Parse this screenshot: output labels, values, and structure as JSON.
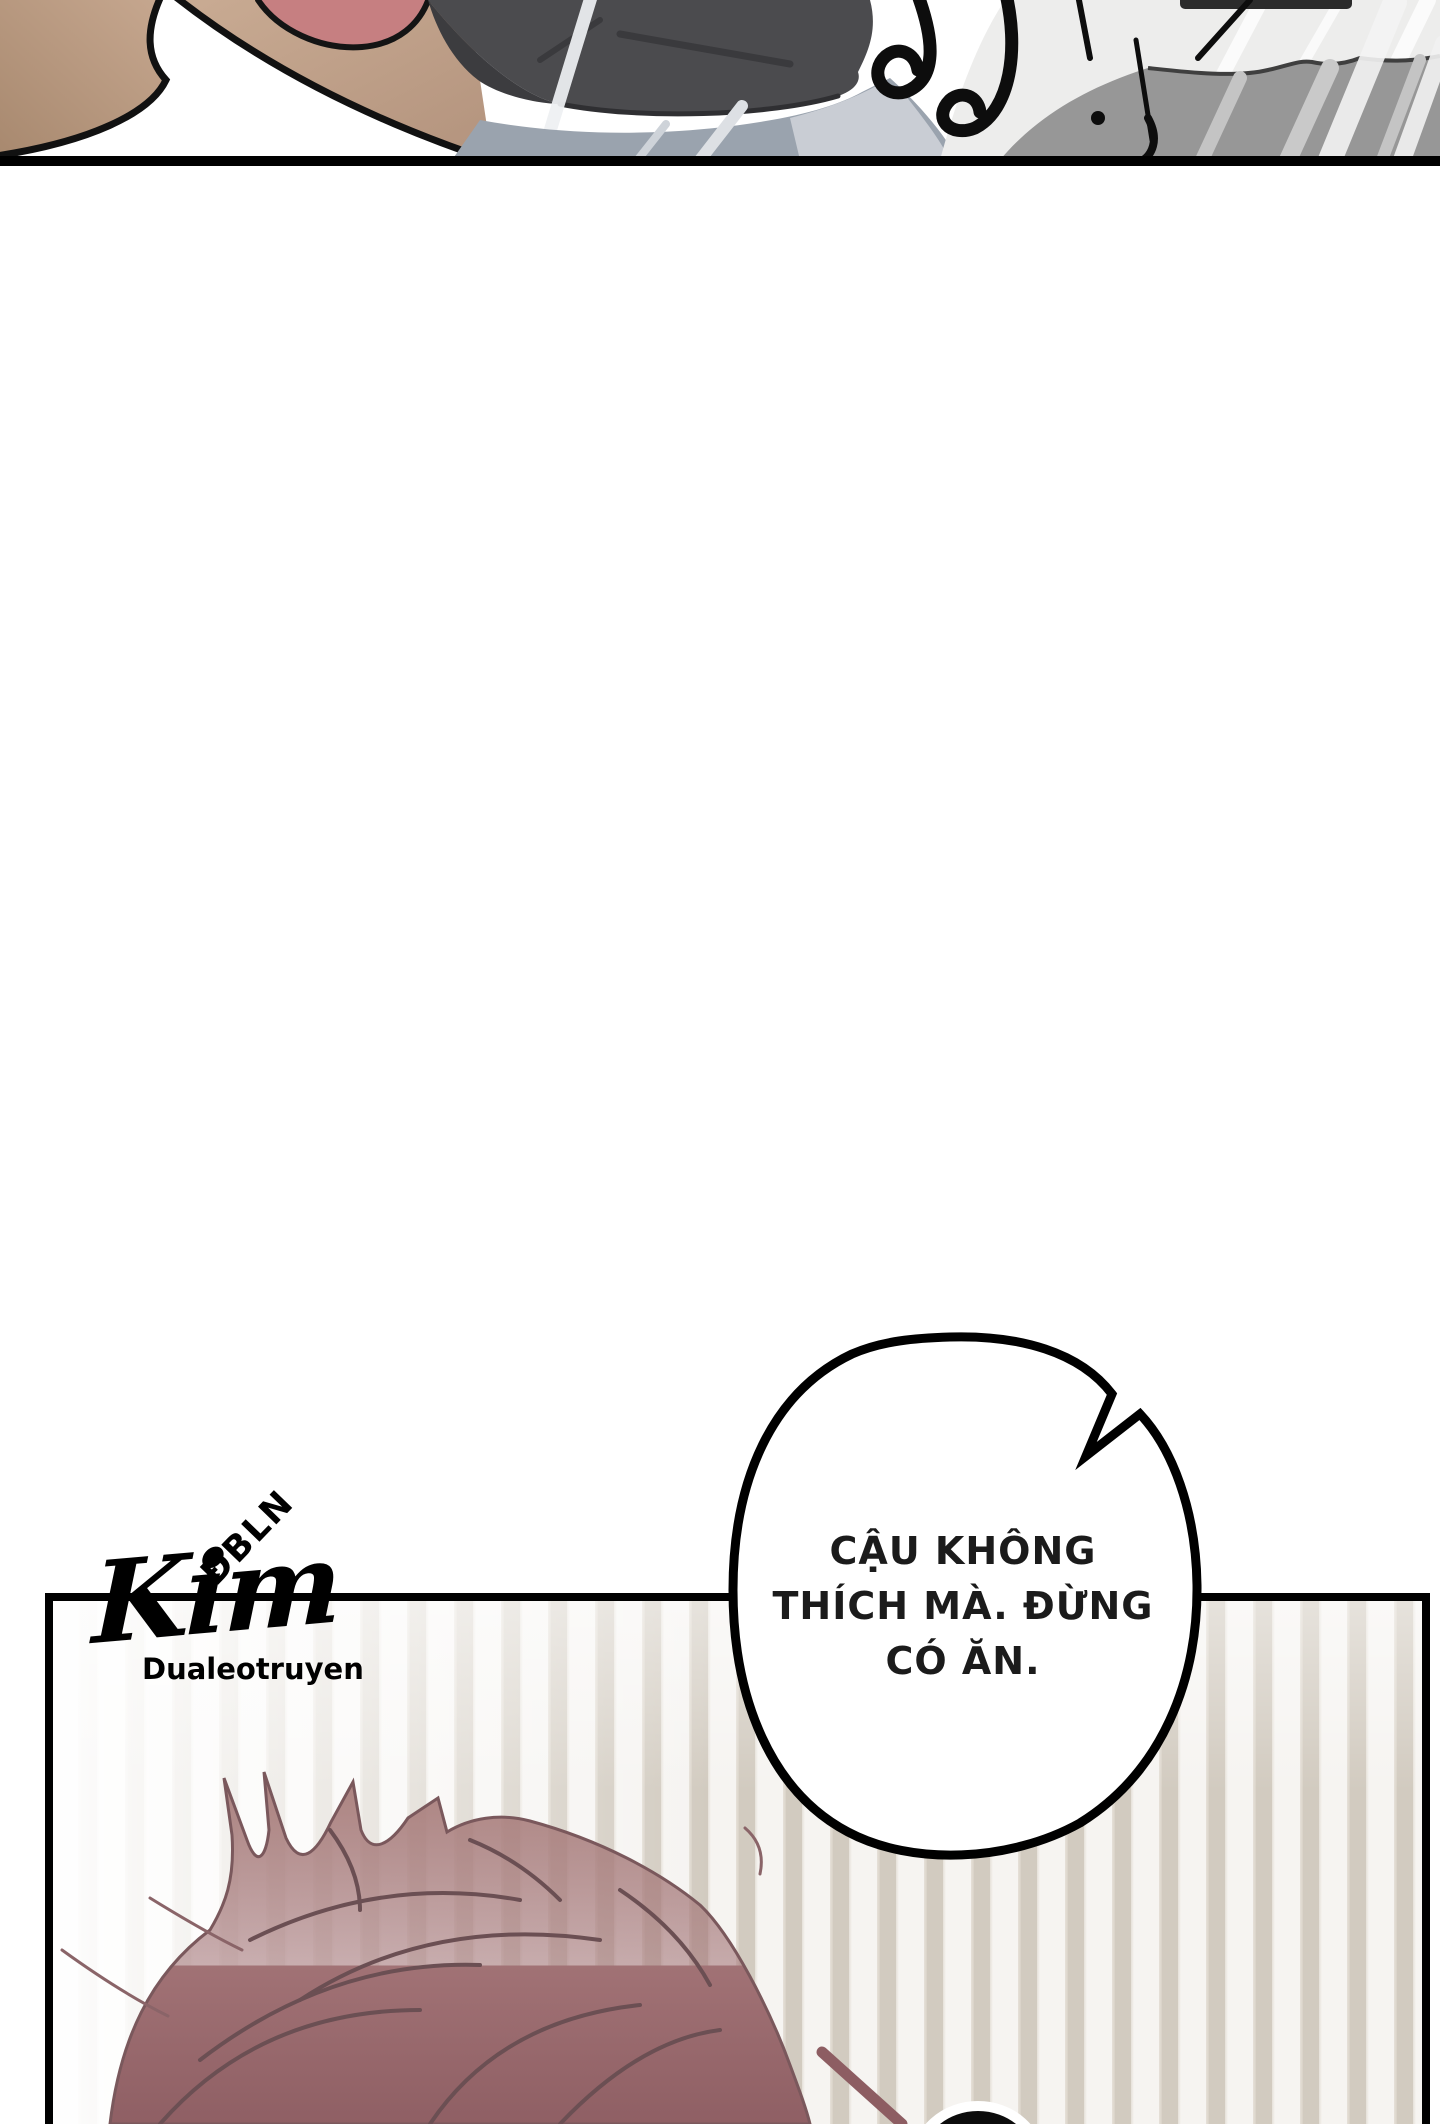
{
  "page": {
    "width": 1440,
    "height": 2124,
    "background": "#ffffff"
  },
  "top_panel": {
    "description": "cropped bottom strip of a manhwa panel",
    "colors": {
      "skin": "#bd9c85",
      "skin_shadow": "#a98a76",
      "mouth_pink": "#c67f81",
      "jacket_dark": "#4b4b4e",
      "fabric_blue_gray": "#9aa3ae",
      "fabric_light": "#ededec",
      "fabric_gray": "#979797",
      "ink": "#000000"
    }
  },
  "speech_bubble": {
    "lines": [
      "CẬU KHÔNG",
      "THÍCH MÀ. ĐỪNG",
      "CÓ ĂN."
    ],
    "fill": "#ffffff",
    "stroke": "#000000",
    "text_color": "#1b1b1b"
  },
  "watermark": {
    "top": "ĐBLN",
    "main": "Kim",
    "sub": "Dualeotruyen",
    "color": "#000000"
  },
  "bottom_panel": {
    "border_color": "#000000",
    "curtain_colors": {
      "light": "#f6f4f1",
      "mid": "#e6e1d9",
      "dark": "#d2cbc0"
    },
    "hair_colors": {
      "top": "#ab827f",
      "bottom": "#8f5f64",
      "line": "#6b4f53"
    }
  }
}
